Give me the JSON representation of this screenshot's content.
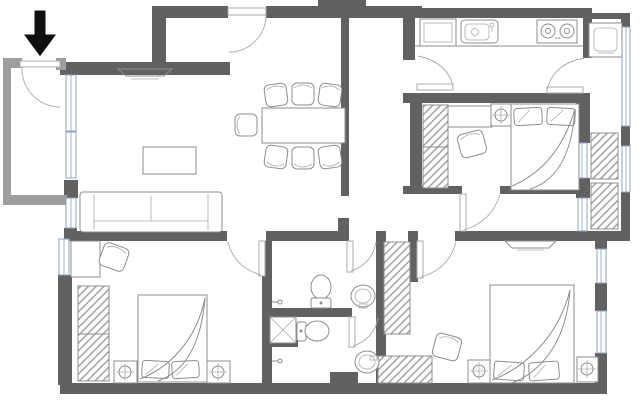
{
  "document": {
    "kind": "apartment floor plan",
    "style": "2D top-down architectural line drawing, no text labels",
    "canvas": {
      "width": 640,
      "height": 401
    }
  },
  "colors": {
    "wall": "#616161",
    "porch-wall": "#9e9e9e",
    "line": "#8d8d8d",
    "line-light": "#ababab",
    "window": "#8fa3c0",
    "hatch": "#9a9a9a",
    "arrow": "#0f0f0f",
    "background": "#ffffff"
  },
  "entrance": {
    "marker": "solid black arrow outside top-left porch pointing down at entry door"
  },
  "symbols": {
    "circle-cross": "bedside lamp on nightstand",
    "square-x": "shower tray with drain",
    "hatched-rect": "wardrobe / hanging storage",
    "double-line-strip": "window glazing",
    "quarter-arc": "door swing"
  },
  "rooms": [
    {
      "name": "entry-porch",
      "position": "top-left",
      "features": [
        "entry door with swing arc",
        "lighter gray outer walls"
      ]
    },
    {
      "name": "living-room",
      "position": "left-center",
      "furniture": [
        "wall-mounted tv",
        "three-seat sofa",
        "coffee table"
      ],
      "windows": [
        "full-height strip on left wall"
      ]
    },
    {
      "name": "dining-area",
      "position": "top-center",
      "furniture": [
        "rectangular table",
        "seven chairs"
      ],
      "doors": [
        "secondary entry door in top wall"
      ]
    },
    {
      "name": "kitchen",
      "position": "top-right",
      "furniture": [
        "tall cabinet/fridge",
        "sink",
        "two-burner stove",
        "counter run"
      ],
      "doors": [
        "door to hall",
        "door to service balcony"
      ]
    },
    {
      "name": "service-balcony",
      "position": "right edge",
      "furniture": [
        "washing machine",
        "two drying racks"
      ],
      "windows": [
        "long outer glazing strips"
      ]
    },
    {
      "name": "bedroom-1",
      "position": "upper-right",
      "furniture": [
        "wardrobe",
        "desk",
        "chair",
        "nightstand with lamp",
        "double bed with quilt"
      ],
      "windows": [
        "right wall to balcony"
      ]
    },
    {
      "name": "bedroom-2",
      "position": "bottom-left",
      "furniture": [
        "desk",
        "chair",
        "two-section wardrobe",
        "double bed with quilt",
        "two nightstands with lamps"
      ],
      "windows": [
        "left wall"
      ]
    },
    {
      "name": "bedroom-3",
      "position": "bottom-right",
      "furniture": [
        "wall-mounted tv",
        "wardrobe column",
        "low wardrobe",
        "chair",
        "double bed with quilt",
        "two nightstands with lamps"
      ],
      "windows": [
        "two on right wall"
      ]
    },
    {
      "name": "wc-upper",
      "position": "center",
      "furniture": [
        "toilet",
        "round basin",
        "wall tap"
      ]
    },
    {
      "name": "bathroom-lower",
      "position": "center-bottom",
      "furniture": [
        "shower tray",
        "toilet",
        "round basin",
        "wall tap"
      ]
    }
  ]
}
